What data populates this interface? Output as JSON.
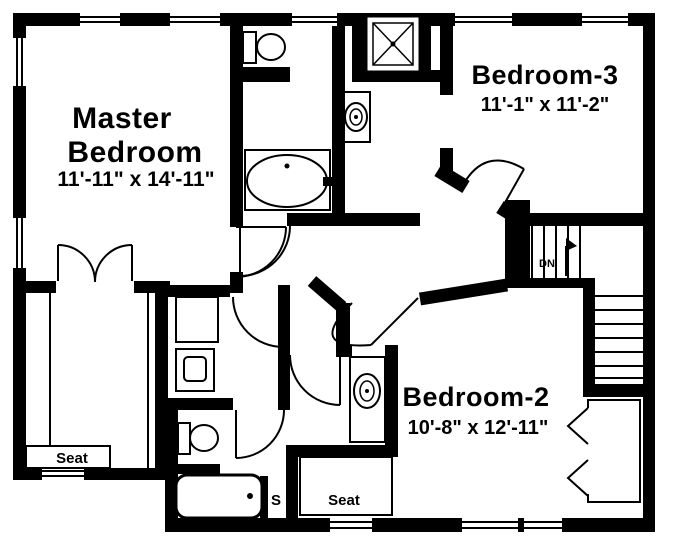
{
  "plan": {
    "colors": {
      "wall": "#000000",
      "background": "#ffffff"
    },
    "master_bedroom": {
      "label_line1": "Master",
      "label_line2": "Bedroom",
      "dims": "11'-11\" x 14'-11\""
    },
    "bedroom3": {
      "label": "Bedroom-3",
      "dims": "11'-1\" x 11'-2\""
    },
    "bedroom2": {
      "label": "Bedroom-2",
      "dims": "10'-8\" x 12'-11\""
    },
    "closet_seat_label": "Seat",
    "bedroom2_seat_label": "Seat",
    "shelf_label": "S",
    "stairs": {
      "down_label": "DN"
    },
    "fixtures": {
      "master_bath": [
        "toilet",
        "oval-bathtub"
      ],
      "upper_bath": [
        "shower",
        "sink"
      ],
      "lower_bath": [
        "sink-vanity",
        "toilet",
        "bathtub"
      ],
      "laundry": [
        "washer",
        "dryer"
      ],
      "closets": [
        "master-walk-in-closet",
        "bedroom2-bifold-closet"
      ]
    }
  }
}
